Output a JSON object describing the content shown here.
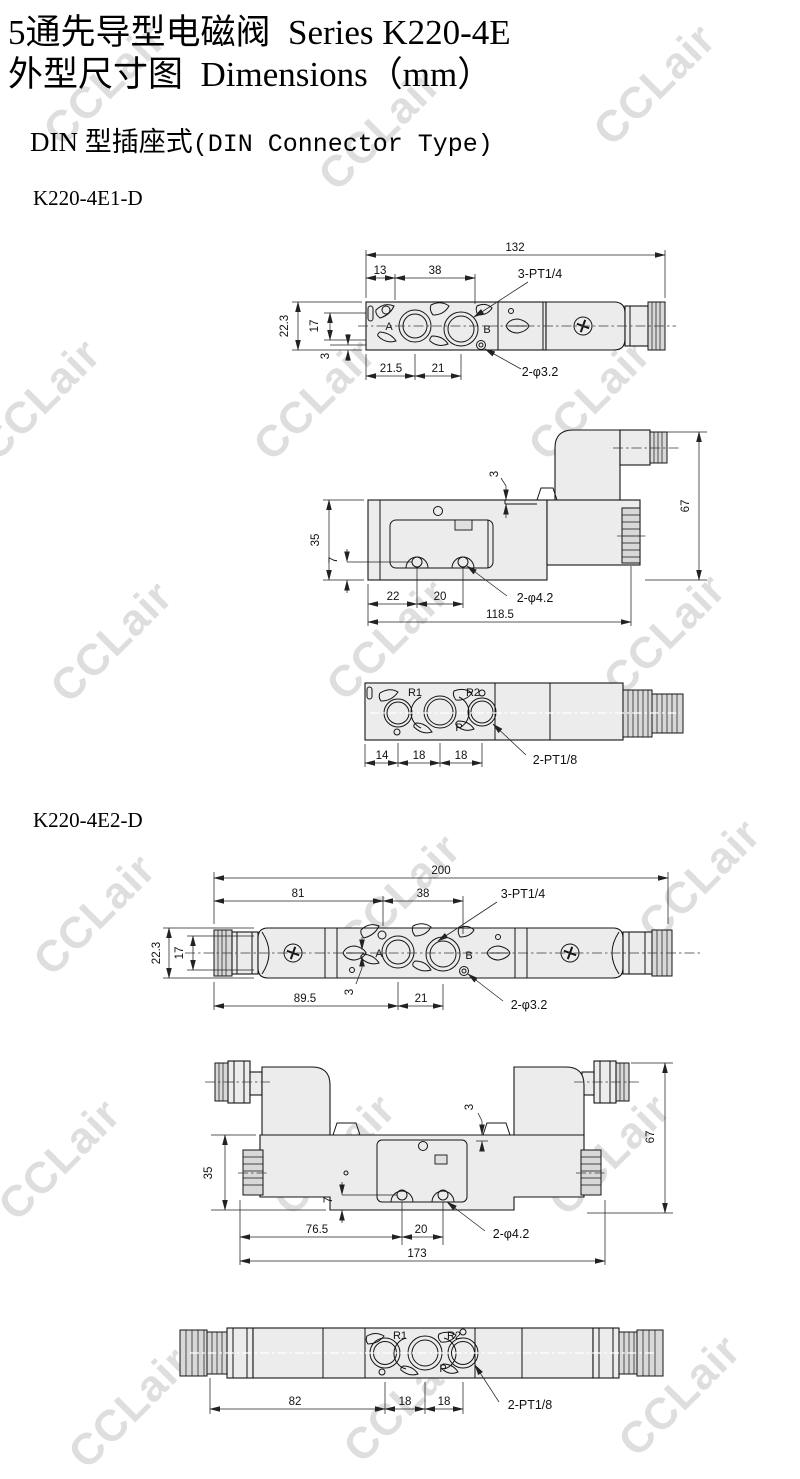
{
  "page": {
    "title_zh": "5通先导型电磁阀",
    "title_en": "Series K220-4E",
    "subtitle_zh": "外型尺寸图",
    "subtitle_en": "Dimensions（mm）",
    "section_zh": "DIN 型插座式",
    "section_en": "(DIN Connector Type)"
  },
  "watermark": {
    "text": "CCLair",
    "color": "#dedede"
  },
  "palette": {
    "line": "#141414",
    "body_fill": "#ececec",
    "rib_fill": "#d8d8d8",
    "background": "#ffffff"
  },
  "model1": {
    "name": "K220-4E1-D",
    "top": {
      "overall": "132",
      "d13": "13",
      "d38": "38",
      "ports": "3-PT1/4",
      "h223": "22.3",
      "h17": "17",
      "h3": "3",
      "d215": "21.5",
      "d21": "21",
      "holes": "2-φ3.2",
      "port_a": "A",
      "port_b": "B"
    },
    "side": {
      "d3": "3",
      "h67": "67",
      "h35": "35",
      "h7": "7",
      "d22": "22",
      "d20": "20",
      "holes": "2-φ4.2",
      "overall": "118.5"
    },
    "bottom": {
      "d14": "14",
      "d18a": "18",
      "d18b": "18",
      "ports": "2-PT1/8",
      "r1": "R1",
      "r2": "R2",
      "p": "P"
    }
  },
  "model2": {
    "name": "K220-4E2-D",
    "top": {
      "overall": "200",
      "d81": "81",
      "d38": "38",
      "ports": "3-PT1/4",
      "h223": "22.3",
      "h17": "17",
      "d895": "89.5",
      "d3": "3",
      "d21": "21",
      "holes": "2-φ3.2",
      "port_a": "A",
      "port_b": "B"
    },
    "side": {
      "d3": "3",
      "h67": "67",
      "h35": "35",
      "h7": "7",
      "d765": "76.5",
      "d20": "20",
      "holes": "2-φ4.2",
      "overall": "173"
    },
    "bottom": {
      "d82": "82",
      "d18a": "18",
      "d18b": "18",
      "ports": "2-PT1/8",
      "r1": "R1",
      "r2": "R2",
      "p": "P"
    }
  }
}
